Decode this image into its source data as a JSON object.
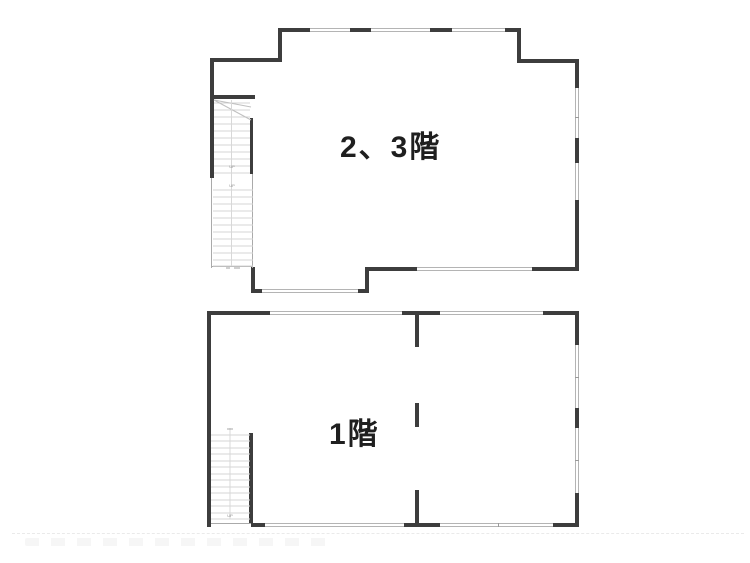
{
  "colors": {
    "background": "#ffffff",
    "wall": "#3d3d3d",
    "window_line": "#b4b4b4",
    "thin_line": "#aaaaaa",
    "tread_line": "#d4d4d4",
    "label_text": "#1f1f1f",
    "tiny_text": "#8f8f8f"
  },
  "upper_plan": {
    "label": "2、3階",
    "stair": {
      "up_label": "UP",
      "mid_label": "UP"
    }
  },
  "lower_plan": {
    "label": "1階",
    "stair": {
      "up_label": "UP"
    }
  }
}
